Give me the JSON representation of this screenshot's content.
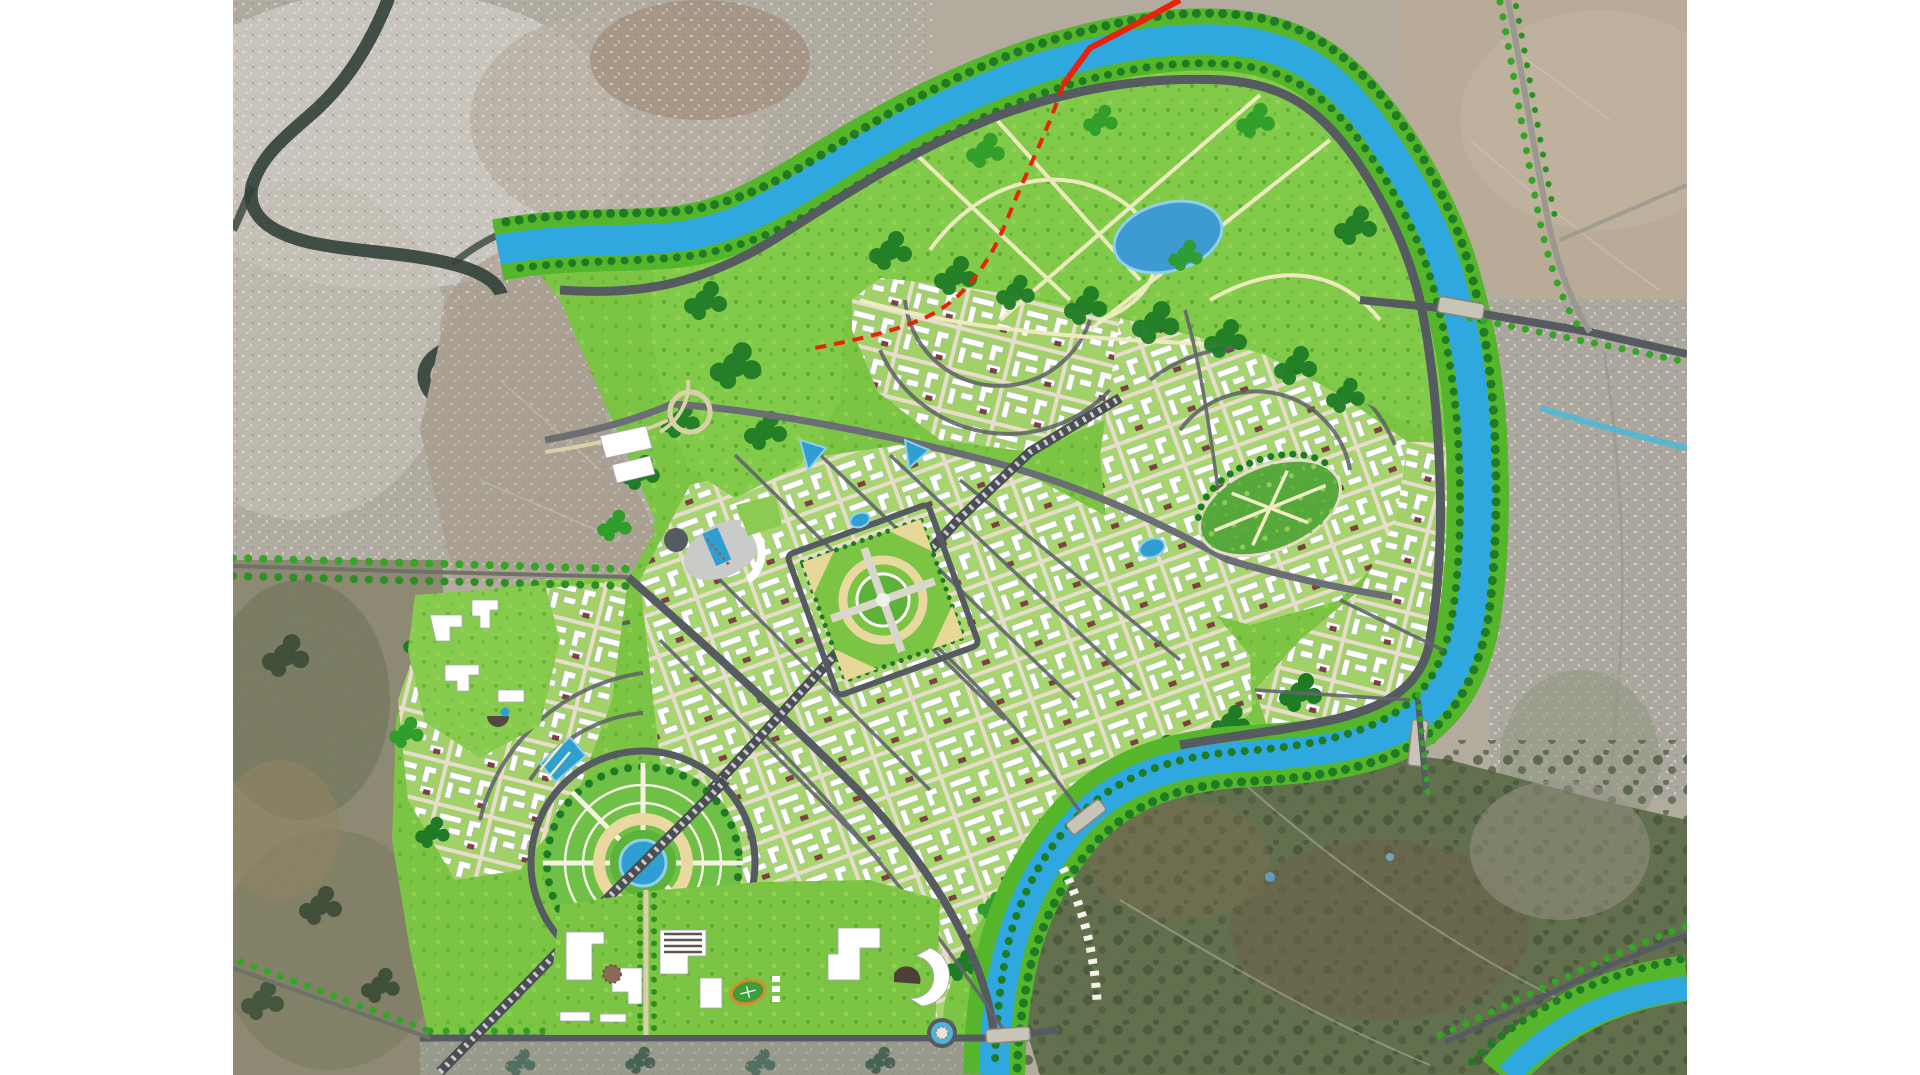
{
  "map": {
    "kind": "urban-master-plan-over-satellite-imagery",
    "description": "Rendered new-city master plan (green parks, blue river channel, gridded districts, grand circular plaza, civic axis) composited over satellite photography of existing terrain and settlements; white margins left and right.",
    "colors": {
      "margin_white": "#ffffff",
      "river_blue": "#2fa8df",
      "river_edge": "#1d8fc4",
      "bank_green": "#55b62c",
      "tree_dark": "#1f7c25",
      "tree_mid": "#2f9e2b",
      "park_green": "#7cc544",
      "fabric_green": "#a7d66e",
      "street_cream": "#e7dcce",
      "road_dark": "#565a61",
      "path_cream": "#f2ecc4",
      "route_red": "#e8220c",
      "ring_cream": "#e9d9a0",
      "pond_teal": "#2e9fd0",
      "building_white": "#ffffff",
      "roof_maroon": "#7e4046",
      "existing_river_dark": "#2a3b33",
      "satellite_urban_grey": "#b0aba1",
      "satellite_barren_tan": "#b9ab97",
      "satellite_hill_green": "#5e6c49",
      "satellite_fields": "#8b8770"
    },
    "features": [
      {
        "id": "existing-city-satellite",
        "label": "Existing city (satellite, north-west)"
      },
      {
        "id": "existing-river",
        "label": "Existing river through old city"
      },
      {
        "id": "planned-river",
        "label": "Planned blue river channel looping around the new town"
      },
      {
        "id": "riverfront-park",
        "label": "Large riverside landscape park with paths and lake"
      },
      {
        "id": "urban-districts",
        "label": "Planned residential/mixed districts with block fabric"
      },
      {
        "id": "grand-circle",
        "label": "Grand circular plaza with radial spokes and central lake"
      },
      {
        "id": "central-square",
        "label": "Central target-pattern square park"
      },
      {
        "id": "civic-axis",
        "label": "Hatched transit/ceremonial axis running SW–NE"
      },
      {
        "id": "civic-quarter",
        "label": "Civic quarter with white institutional buildings and stadium"
      },
      {
        "id": "west-campus",
        "label": "Western campus of white buildings"
      },
      {
        "id": "gateway-plaza",
        "label": "Western gateway plaza with crescent building and pond"
      },
      {
        "id": "east-oval-park",
        "label": "Eastern district oval park"
      },
      {
        "id": "red-route",
        "label": "Red proposed corridor crossing the river"
      },
      {
        "id": "tree-lined-avenues",
        "label": "Tree-dotted avenues extending into satellite terrain"
      },
      {
        "id": "river-bridges",
        "label": "Bridges across the planned river"
      },
      {
        "id": "southeast-canal",
        "label": "Planned green-banked canal, bottom-right corner"
      }
    ]
  }
}
